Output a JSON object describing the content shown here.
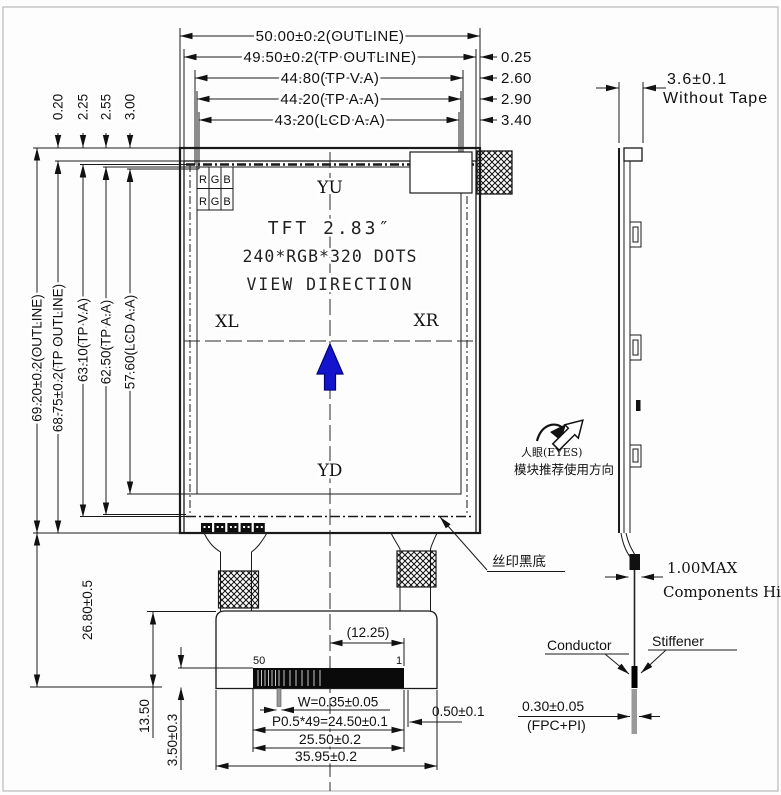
{
  "colors": {
    "line": "#1a1a1a",
    "arrow_blue": "#1414cc",
    "arrow_blue_dark": "#000080",
    "page_border": "#b8b8b8",
    "stiffener_gray": "#9a9a9a"
  },
  "front_view": {
    "dims_top": [
      "50.00±0.2(OUTLINE)",
      "49.50±0.2(TP OUTLINE)",
      "44.80(TP V.A)",
      "44.20(TP A.A)",
      "43.20(LCD A.A)"
    ],
    "offsets_right": [
      "0.25",
      "2.60",
      "2.90",
      "3.40"
    ],
    "offsets_top_left": [
      "0.20",
      "2.25",
      "2.55",
      "3.00"
    ],
    "dims_left": [
      "69.20±0.2(OUTLINE)",
      "68.75±0.2(TP OUTLINE)",
      "63.10(TP V.A)",
      "62.50(TP A.A)",
      "57.60(LCD A.A)"
    ],
    "rgb_table": [
      "R",
      "G",
      "B",
      "R",
      "G",
      "B"
    ],
    "screen": {
      "top_marker": "YU",
      "bottom_marker": "YD",
      "left_marker": "XL",
      "right_marker": "XR",
      "size": "TFT 2.83″",
      "resolution": "240*RGB*320 DOTS",
      "view": "VIEW DIRECTION"
    },
    "silk_label": "丝印黑底",
    "pins": {
      "first": "50",
      "last": "1"
    },
    "dims_bottom": {
      "pitch_ref": "(12.25)",
      "pin_width": "W=0.35±0.05",
      "pitch": "P0.5*49=24.50±0.1",
      "conn_width": "25.50±0.2",
      "fpc_width": "35.95±0.2",
      "margin": "0.50±0.1",
      "fpc_length": "26.80±0.5",
      "tail": "13.50",
      "conn_height": "3.50±0.3"
    }
  },
  "side_view": {
    "thickness": "3.6±0.1",
    "thickness_note": "Without Tape",
    "component": "1.00MAX",
    "component_note": "Components Hight",
    "conductor": "Conductor",
    "stiffener": "Stiffener",
    "fpc_thickness": "0.30±0.05",
    "fpc_note": "(FPC+PI)",
    "eyes": "人眼(EYES)",
    "direction_note": "模块推荐使用方向"
  }
}
